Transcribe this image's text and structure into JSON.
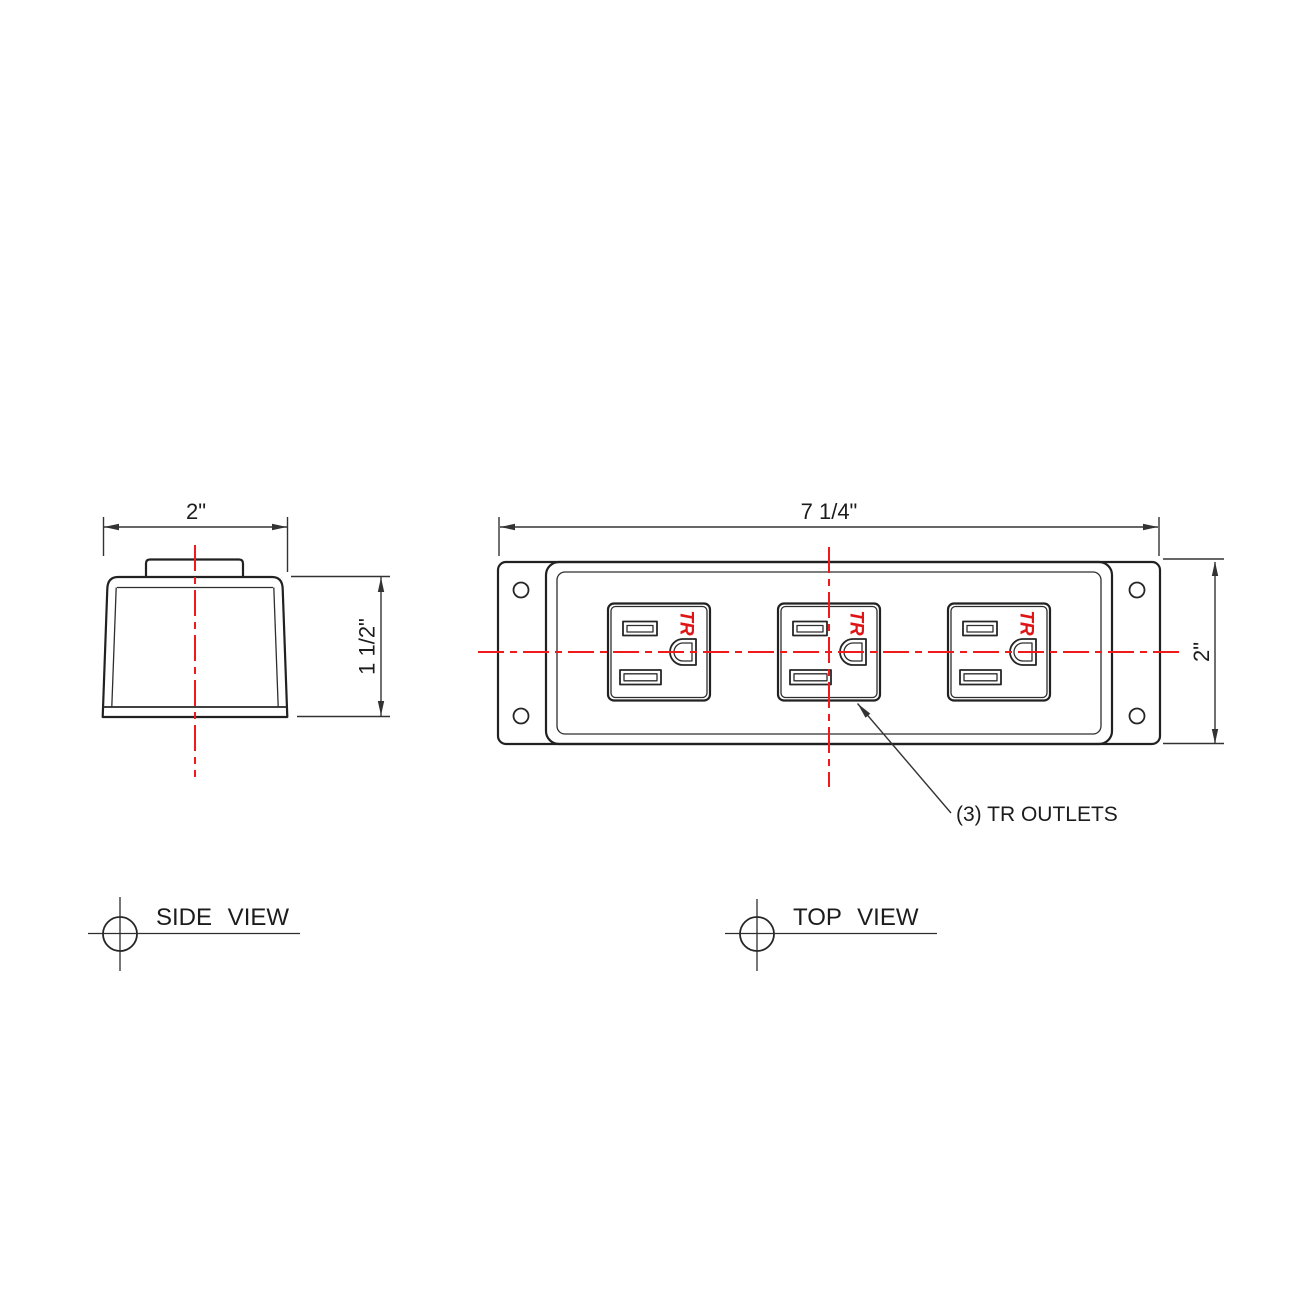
{
  "colors": {
    "centerline": "#f01a1a",
    "tr": "#e01414",
    "object_line": "#212121",
    "dim_line": "#333333",
    "background": "#ffffff"
  },
  "side_view": {
    "label": "SIDE VIEW",
    "width_dim": "2\"",
    "height_dim": "1 1/2\""
  },
  "top_view": {
    "label": "TOP VIEW",
    "width_dim": "7 1/4\"",
    "height_dim": "2\"",
    "annotation": "(3) TR OUTLETS",
    "outlets": {
      "count": 3,
      "tr_label": "TR"
    }
  }
}
